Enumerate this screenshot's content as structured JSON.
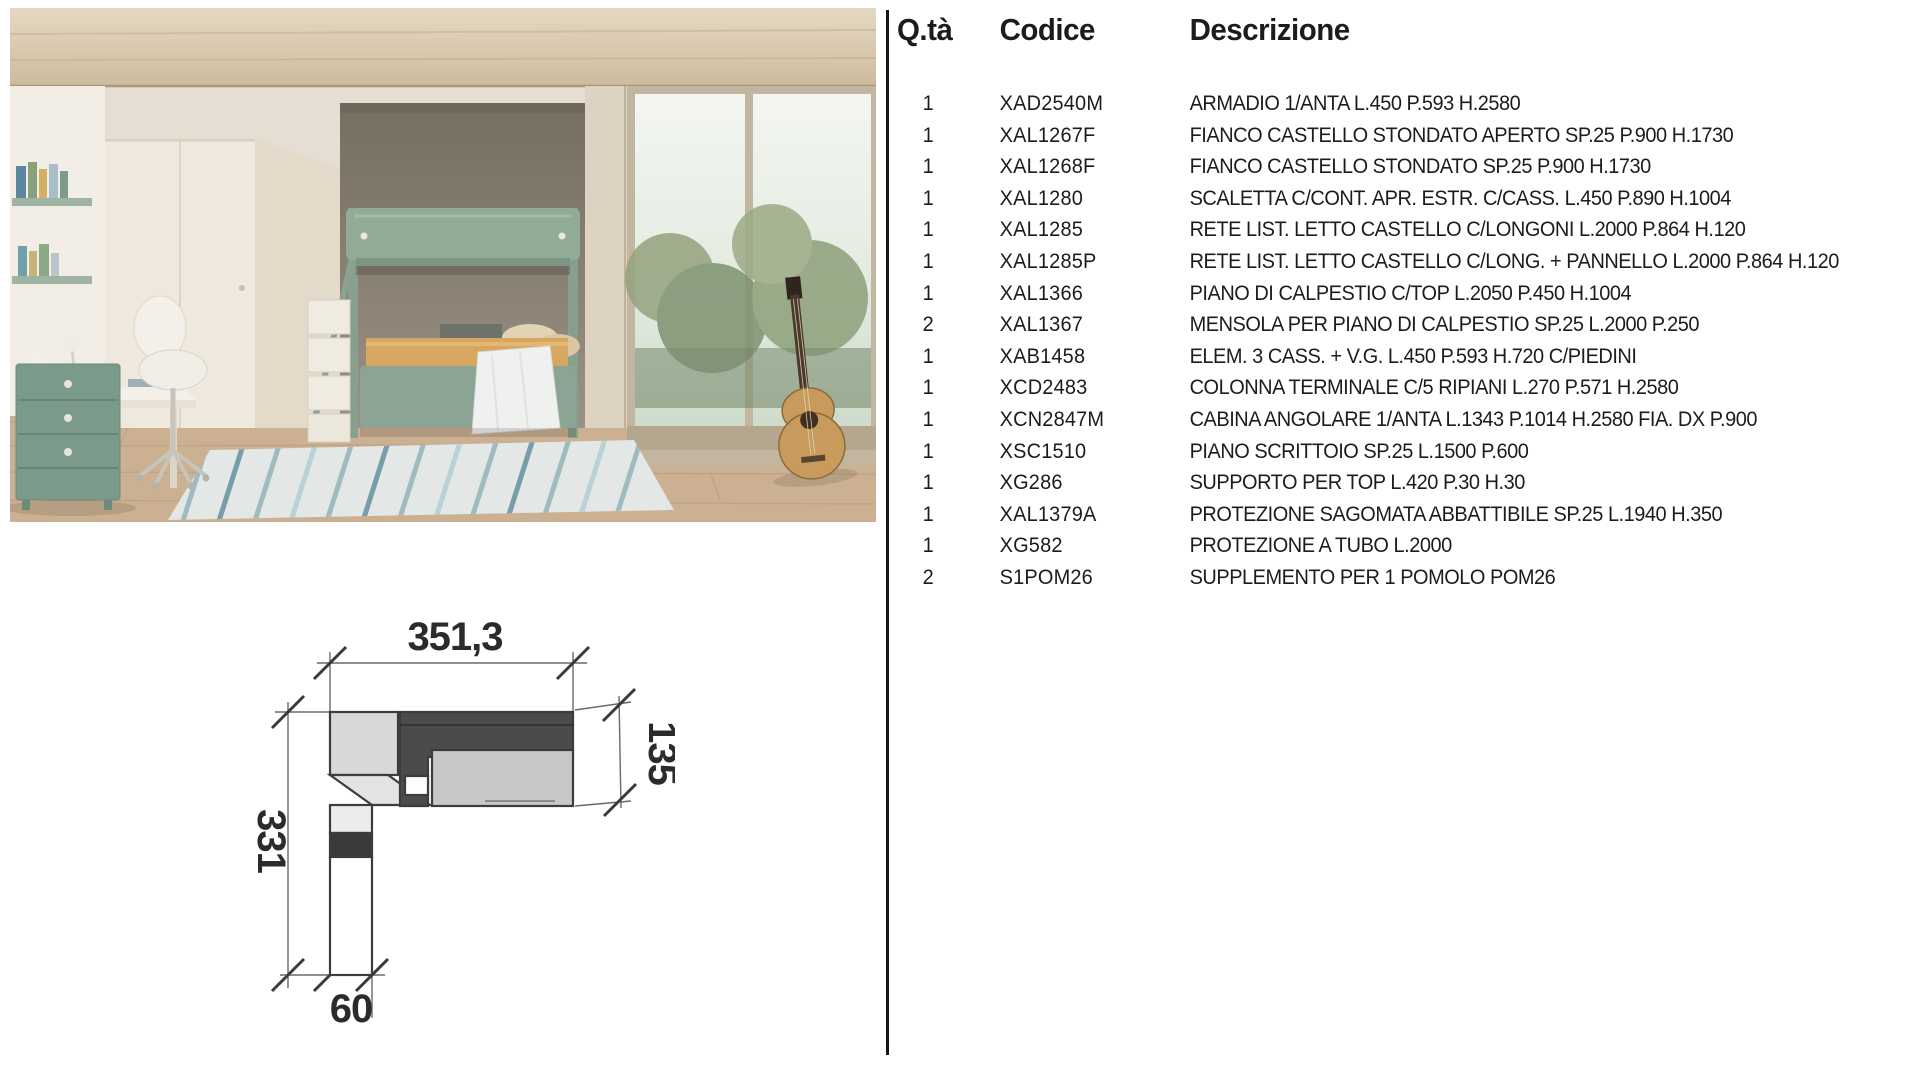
{
  "colors": {
    "accent_green": "#8fa795",
    "drawer_green": "#7c9a8a",
    "alcove_gray": "#8b8274",
    "floor_wood": "#cbb091",
    "divider_black": "#161616"
  },
  "parts_table": {
    "headers": {
      "qty": "Q.tà",
      "code": "Codice",
      "desc": "Descrizione"
    },
    "rows": [
      {
        "qty": "1",
        "code": "XAD2540M",
        "desc": "ARMADIO 1/ANTA L.450 P.593 H.2580"
      },
      {
        "qty": "1",
        "code": "XAL1267F",
        "desc": "FIANCO CASTELLO STONDATO APERTO SP.25 P.900 H.1730"
      },
      {
        "qty": "1",
        "code": "XAL1268F",
        "desc": "FIANCO CASTELLO STONDATO SP.25 P.900 H.1730"
      },
      {
        "qty": "1",
        "code": "XAL1280",
        "desc": "SCALETTA C/CONT. APR. ESTR. C/CASS. L.450 P.890 H.1004"
      },
      {
        "qty": "1",
        "code": "XAL1285",
        "desc": "RETE LIST. LETTO CASTELLO C/LONGONI L.2000 P.864 H.120"
      },
      {
        "qty": "1",
        "code": "XAL1285P",
        "desc": "RETE LIST. LETTO CASTELLO C/LONG. + PANNELLO L.2000 P.864 H.120"
      },
      {
        "qty": "1",
        "code": "XAL1366",
        "desc": "PIANO DI CALPESTIO C/TOP L.2050 P.450 H.1004"
      },
      {
        "qty": "2",
        "code": "XAL1367",
        "desc": "MENSOLA PER PIANO DI CALPESTIO SP.25 L.2000 P.250"
      },
      {
        "qty": "1",
        "code": "XAB1458",
        "desc": "ELEM. 3 CASS. + V.G. L.450 P.593 H.720 C/PIEDINI"
      },
      {
        "qty": "1",
        "code": "XCD2483",
        "desc": "COLONNA TERMINALE C/5 RIPIANI L.270 P.571 H.2580"
      },
      {
        "qty": "1",
        "code": "XCN2847M",
        "desc": "CABINA ANGOLARE 1/ANTA L.1343 P.1014 H.2580 FIA. DX P.900"
      },
      {
        "qty": "1",
        "code": "XSC1510",
        "desc": "PIANO SCRITTOIO SP.25 L.1500 P.600"
      },
      {
        "qty": "1",
        "code": "XG286",
        "desc": "SUPPORTO PER TOP L.420 P.30 H.30"
      },
      {
        "qty": "1",
        "code": "XAL1379A",
        "desc": "PROTEZIONE SAGOMATA ABBATTIBILE SP.25 L.1940 H.350"
      },
      {
        "qty": "1",
        "code": "XG582",
        "desc": "PROTEZIONE A TUBO L.2000"
      },
      {
        "qty": "2",
        "code": "S1POM26",
        "desc": "SUPPLEMENTO PER 1 POMOLO POM26"
      }
    ]
  },
  "plan": {
    "dims": {
      "top": "351,3",
      "right": "135",
      "left": "331",
      "bottom": "60"
    }
  }
}
